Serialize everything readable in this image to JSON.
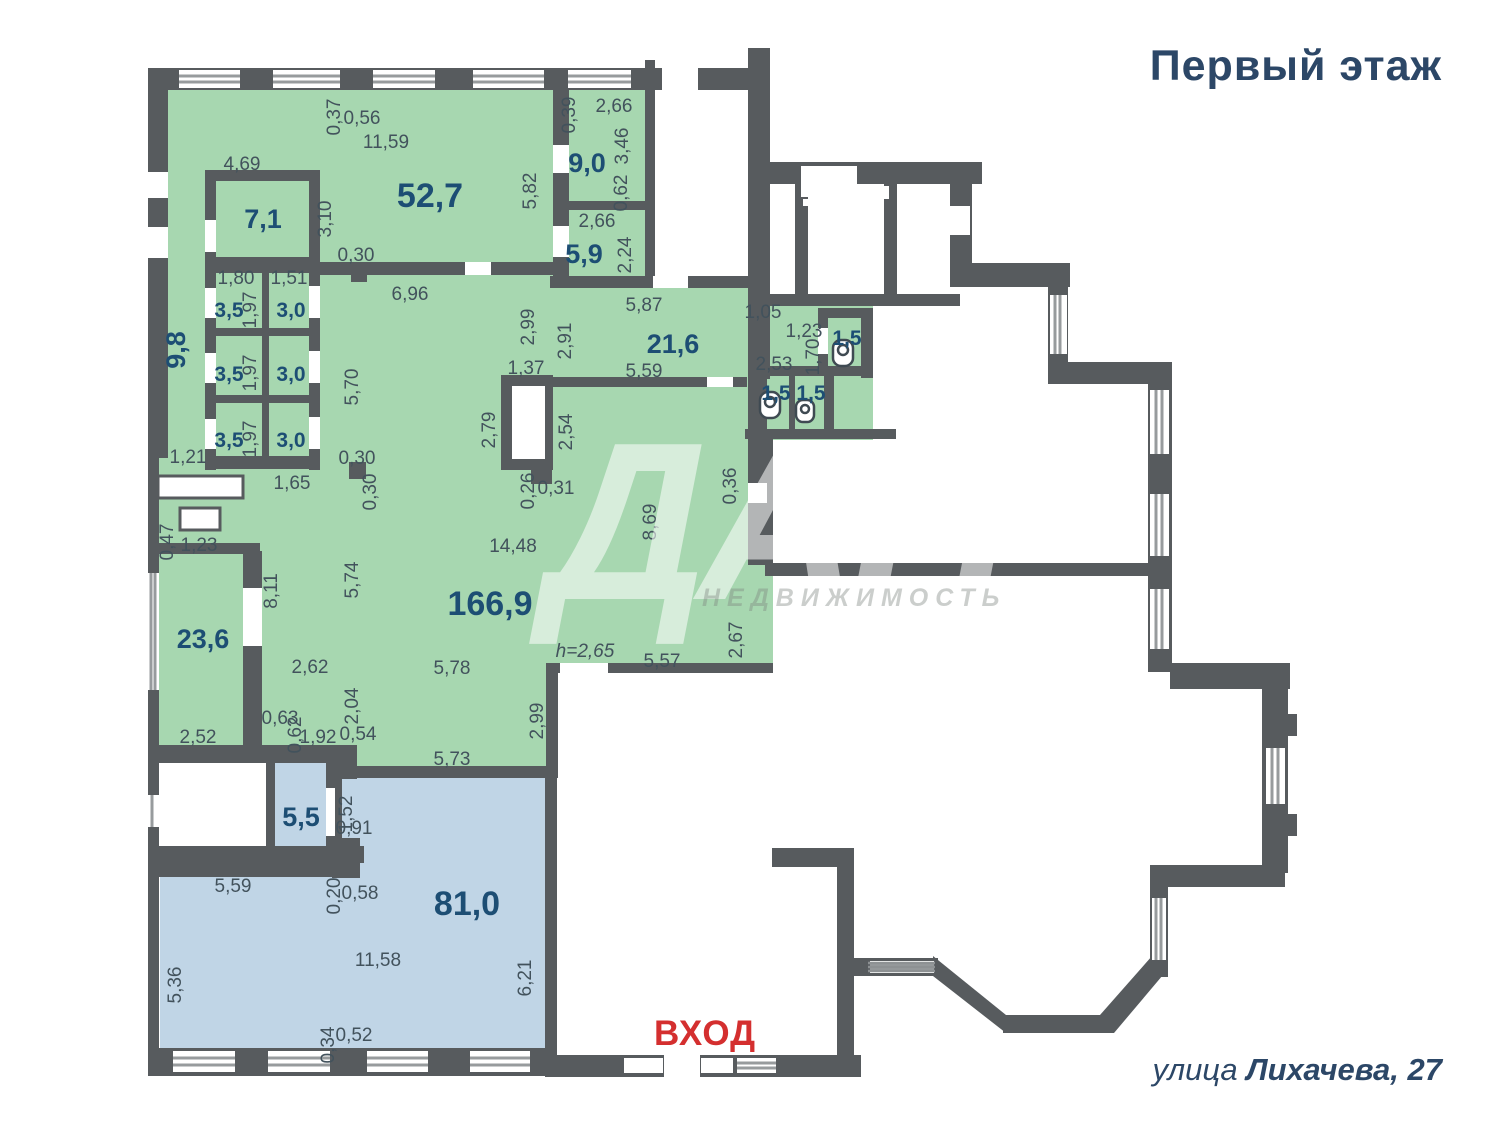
{
  "header": {
    "title": "Первый этаж"
  },
  "footer": {
    "address_prefix": "улица ",
    "address_bold": "Лихачева, 27"
  },
  "entrance": {
    "label": "ВХОД"
  },
  "watermark": {
    "logo": "ДАН",
    "subtitle": "НЕДВИЖИМОСТЬ"
  },
  "colors": {
    "wall": "#575b5e",
    "green": "#a7d7b0",
    "blue": "#c0d5e6",
    "area": "#1d4e74",
    "dim": "#42525c",
    "red": "#d42f2f",
    "title": "#2c4767"
  },
  "plan": {
    "area_labels": [
      {
        "name": "room-52-7",
        "text": "52,7",
        "x": 430,
        "y": 207,
        "cls": "area-lg"
      },
      {
        "name": "room-166-9",
        "text": "166,9",
        "x": 490,
        "y": 615,
        "cls": "area-lg"
      },
      {
        "name": "room-81-0",
        "text": "81,0",
        "x": 467,
        "y": 915,
        "cls": "area-lg"
      },
      {
        "name": "room-7-1",
        "text": "7,1",
        "x": 263,
        "y": 228,
        "cls": "area-md"
      },
      {
        "name": "room-9-0",
        "text": "9,0",
        "x": 587,
        "y": 172,
        "cls": "area-md"
      },
      {
        "name": "room-5-9",
        "text": "5,9",
        "x": 584,
        "y": 263,
        "cls": "area-md"
      },
      {
        "name": "room-21-6",
        "text": "21,6",
        "x": 673,
        "y": 353,
        "cls": "area-md"
      },
      {
        "name": "room-23-6",
        "text": "23,6",
        "x": 203,
        "y": 648,
        "cls": "area-md"
      },
      {
        "name": "room-5-5",
        "text": "5,5",
        "x": 301,
        "y": 826,
        "cls": "area-md"
      },
      {
        "name": "room-9-8",
        "text": "9,8",
        "x": 185,
        "y": 350,
        "cls": "area-md",
        "rot": true
      },
      {
        "name": "room-3-5-a",
        "text": "3,5",
        "x": 229,
        "y": 317,
        "cls": "area-sm"
      },
      {
        "name": "room-3-0-a",
        "text": "3,0",
        "x": 291,
        "y": 317,
        "cls": "area-sm"
      },
      {
        "name": "room-3-5-b",
        "text": "3,5",
        "x": 229,
        "y": 381,
        "cls": "area-sm"
      },
      {
        "name": "room-3-0-b",
        "text": "3,0",
        "x": 291,
        "y": 381,
        "cls": "area-sm"
      },
      {
        "name": "room-3-5-c",
        "text": "3,5",
        "x": 229,
        "y": 447,
        "cls": "area-sm"
      },
      {
        "name": "room-3-0-c",
        "text": "3,0",
        "x": 291,
        "y": 447,
        "cls": "area-sm"
      },
      {
        "name": "room-1-5-a",
        "text": "1,5",
        "x": 847,
        "y": 345,
        "cls": "area-sm"
      },
      {
        "name": "room-1-5-b",
        "text": "1,5",
        "x": 776,
        "y": 400,
        "cls": "area-sm"
      },
      {
        "name": "room-1-5-c",
        "text": "1,5",
        "x": 811,
        "y": 400,
        "cls": "area-sm"
      }
    ],
    "dim_labels": [
      {
        "text": "0,37",
        "x": 340,
        "y": 117,
        "rot": true
      },
      {
        "text": "0,56",
        "x": 362,
        "y": 124
      },
      {
        "text": "11,59",
        "x": 386,
        "y": 148
      },
      {
        "text": "4,69",
        "x": 242,
        "y": 170
      },
      {
        "text": "3,10",
        "x": 331,
        "y": 219,
        "rot": true
      },
      {
        "text": "5,82",
        "x": 536,
        "y": 191,
        "rot": true
      },
      {
        "text": "0,39",
        "x": 575,
        "y": 115,
        "rot": true
      },
      {
        "text": "2,66",
        "x": 614,
        "y": 112
      },
      {
        "text": "3,46",
        "x": 628,
        "y": 146,
        "rot": true
      },
      {
        "text": "0,62",
        "x": 627,
        "y": 193,
        "rot": true
      },
      {
        "text": "2,66",
        "x": 597,
        "y": 227
      },
      {
        "text": "2,24",
        "x": 631,
        "y": 255,
        "rot": true
      },
      {
        "text": "0,30",
        "x": 356,
        "y": 261
      },
      {
        "text": "6,96",
        "x": 410,
        "y": 300
      },
      {
        "text": "1,80",
        "x": 236,
        "y": 284
      },
      {
        "text": "1,51",
        "x": 289,
        "y": 284
      },
      {
        "text": "1,97",
        "x": 256,
        "y": 310,
        "rot": true
      },
      {
        "text": "1,97",
        "x": 256,
        "y": 373,
        "rot": true
      },
      {
        "text": "1,97",
        "x": 256,
        "y": 439,
        "rot": true
      },
      {
        "text": "5,87",
        "x": 644,
        "y": 311
      },
      {
        "text": "1,05",
        "x": 763,
        "y": 318
      },
      {
        "text": "1,23",
        "x": 804,
        "y": 337
      },
      {
        "text": "1,70",
        "x": 819,
        "y": 357,
        "rot": true
      },
      {
        "text": "2,53",
        "x": 774,
        "y": 370
      },
      {
        "text": "2,99",
        "x": 534,
        "y": 327,
        "rot": true
      },
      {
        "text": "2,91",
        "x": 571,
        "y": 341,
        "rot": true
      },
      {
        "text": "5,59",
        "x": 644,
        "y": 377
      },
      {
        "text": "1,37",
        "x": 526,
        "y": 374
      },
      {
        "text": "2,79",
        "x": 495,
        "y": 430,
        "rot": true
      },
      {
        "text": "2,54",
        "x": 572,
        "y": 432,
        "rot": true
      },
      {
        "text": "5,70",
        "x": 358,
        "y": 387,
        "rot": true
      },
      {
        "text": "1,21",
        "x": 188,
        "y": 463
      },
      {
        "text": "1,65",
        "x": 292,
        "y": 489
      },
      {
        "text": "0,30",
        "x": 357,
        "y": 464
      },
      {
        "text": "0,30",
        "x": 376,
        "y": 492,
        "rot": true
      },
      {
        "text": "0,26",
        "x": 534,
        "y": 491,
        "rot": true
      },
      {
        "text": "0,31",
        "x": 556,
        "y": 494
      },
      {
        "text": "0,36",
        "x": 736,
        "y": 486,
        "rot": true
      },
      {
        "text": "8,69",
        "x": 656,
        "y": 522,
        "rot": true
      },
      {
        "text": "14,48",
        "x": 513,
        "y": 552
      },
      {
        "text": "0,47",
        "x": 173,
        "y": 542,
        "rot": true
      },
      {
        "text": "1,23",
        "x": 199,
        "y": 551
      },
      {
        "text": "8,11",
        "x": 277,
        "y": 591,
        "rot": true
      },
      {
        "text": "5,74",
        "x": 358,
        "y": 580,
        "rot": true
      },
      {
        "text": "2,62",
        "x": 310,
        "y": 673
      },
      {
        "text": "2,04",
        "x": 358,
        "y": 706,
        "rot": true
      },
      {
        "text": "h=2,65",
        "x": 585,
        "y": 657,
        "italic": true
      },
      {
        "text": "5,57",
        "x": 662,
        "y": 667
      },
      {
        "text": "5,78",
        "x": 452,
        "y": 674
      },
      {
        "text": "2,67",
        "x": 742,
        "y": 640,
        "rot": true
      },
      {
        "text": "0,63",
        "x": 280,
        "y": 724
      },
      {
        "text": "0,62",
        "x": 301,
        "y": 735,
        "rot": true
      },
      {
        "text": "1,92",
        "x": 318,
        "y": 743
      },
      {
        "text": "0,54",
        "x": 358,
        "y": 740
      },
      {
        "text": "2,52",
        "x": 198,
        "y": 743
      },
      {
        "text": "5,73",
        "x": 452,
        "y": 765
      },
      {
        "text": "2,99",
        "x": 543,
        "y": 721,
        "rot": true
      },
      {
        "text": "1,52",
        "x": 352,
        "y": 814,
        "rot": true
      },
      {
        "text": "0,91",
        "x": 354,
        "y": 834
      },
      {
        "text": "5,59",
        "x": 233,
        "y": 892
      },
      {
        "text": "0,20",
        "x": 340,
        "y": 896,
        "rot": true
      },
      {
        "text": "0,58",
        "x": 360,
        "y": 899
      },
      {
        "text": "11,58",
        "x": 378,
        "y": 966
      },
      {
        "text": "5,36",
        "x": 181,
        "y": 985,
        "rot": true
      },
      {
        "text": "6,21",
        "x": 531,
        "y": 978,
        "rot": true
      },
      {
        "text": "0,34",
        "x": 334,
        "y": 1045,
        "rot": true
      },
      {
        "text": "0,52",
        "x": 354,
        "y": 1041
      }
    ]
  }
}
